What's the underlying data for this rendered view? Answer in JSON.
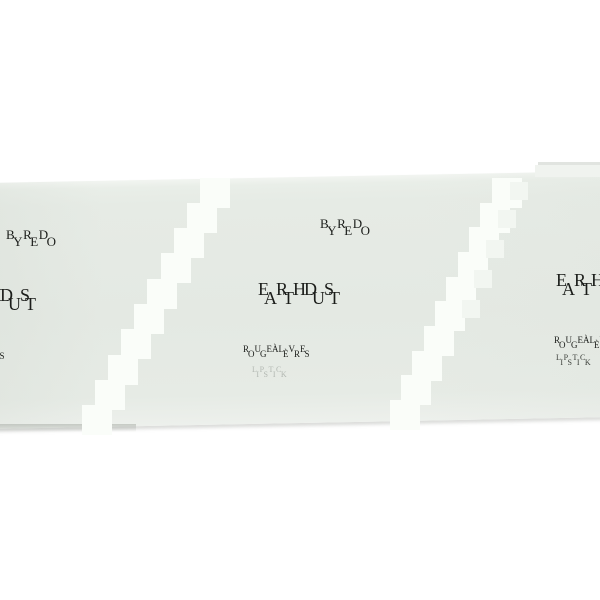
{
  "photo": {
    "description": "Product photo of a pale sage-green lipstick box on a white background, low-resolution with doubled glitched lettering and two stepped white glare bands",
    "background_color": "#ffffff",
    "box_color": "#e6ebe5",
    "glare_color": "#fafdf9",
    "text_color": "#1b1d1a",
    "shadow_color": "#a5aaa3"
  },
  "product": {
    "brand": "BYREDO",
    "name": "EARTH DUST",
    "type_fr": "ROUGE À LÈVRES",
    "type_en": "LIPSTICK"
  }
}
